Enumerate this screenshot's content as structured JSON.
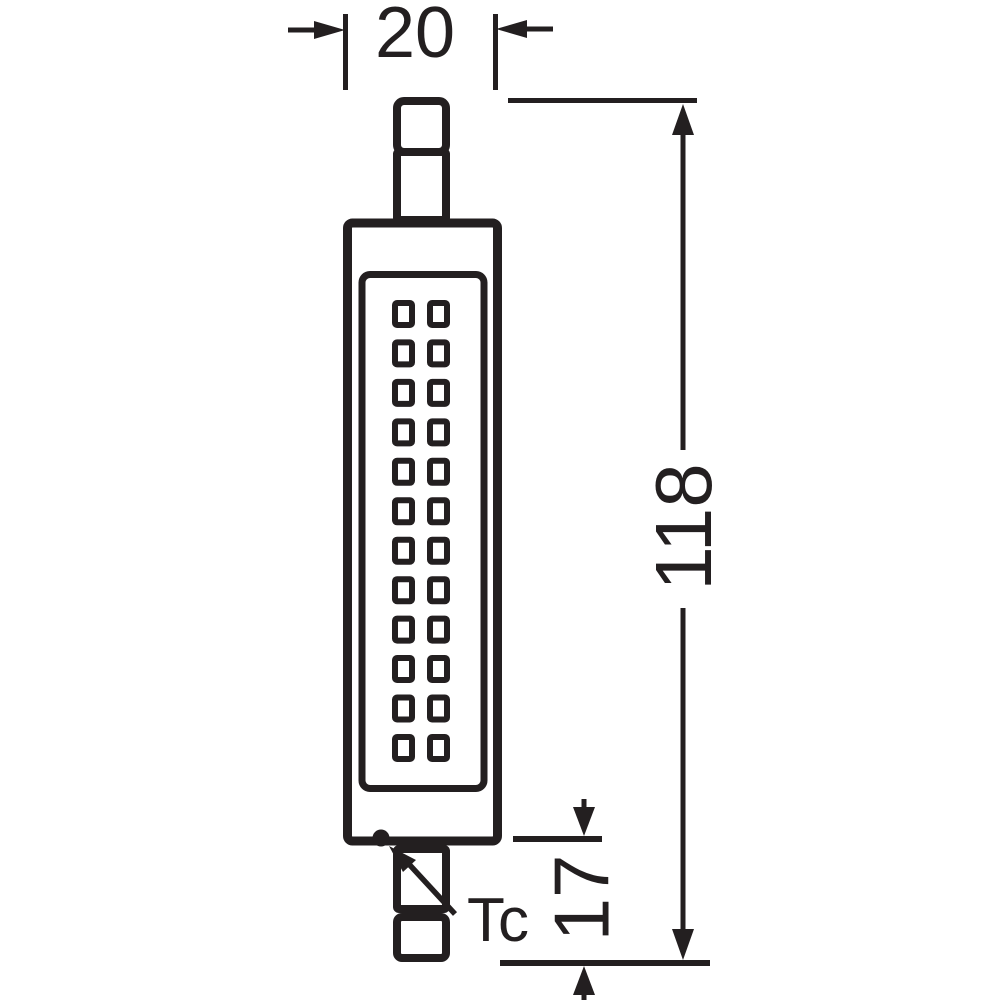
{
  "drawing": {
    "colors": {
      "ink": "#231f20",
      "background": "#ffffff"
    },
    "dimensions": {
      "width_label": "20",
      "length_label": "118",
      "base_label": "17",
      "thermal_point_label": "Tc"
    },
    "led_grid": {
      "rows": 12,
      "columns": 2
    }
  }
}
